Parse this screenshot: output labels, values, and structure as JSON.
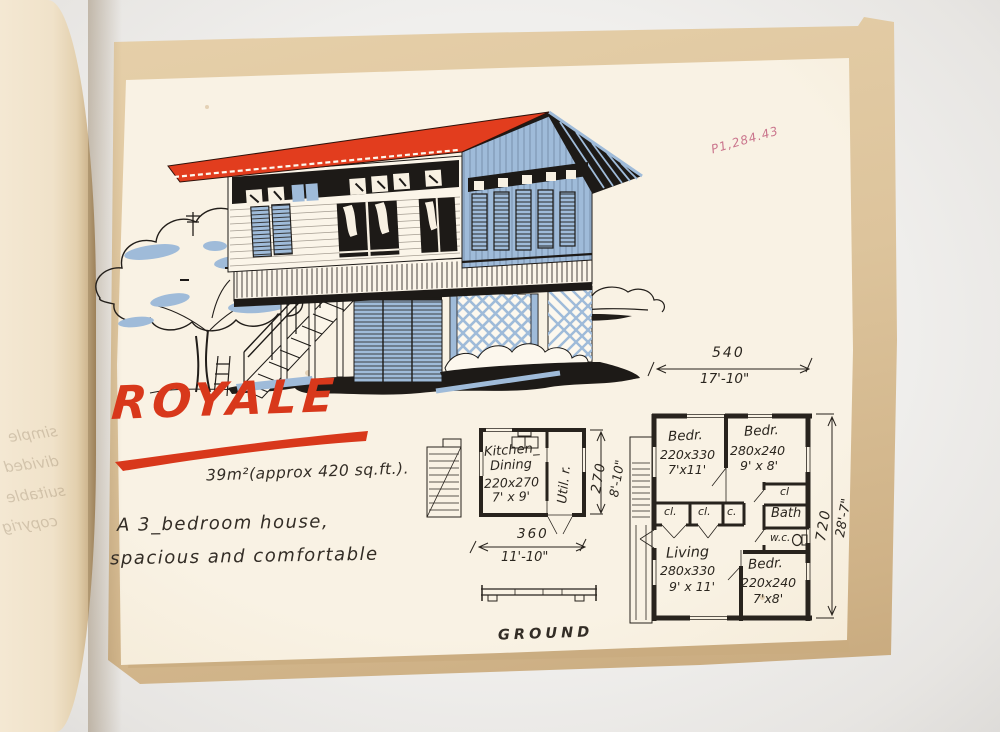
{
  "book": {
    "stamp": "P1,284.43",
    "showthrough": {
      "line1": "simple",
      "line2": "divided",
      "line3": "suitable",
      "line4": "copyrig"
    }
  },
  "page": {
    "title": "ROYALE",
    "area_note": "39m²(approx 420 sq.ft.).",
    "description": {
      "line1": "A  3_bedroom  house,",
      "line2": "spacious  and  comfortable"
    },
    "plan_label": "GROUND"
  },
  "ground_plan": {
    "kitchen": {
      "name1": "Kitchen_",
      "name2": "Dining",
      "size_cm": "220x270",
      "size_ft": "7' x 9'"
    },
    "utility": "Util. r.",
    "dim_width": {
      "cm": "360",
      "ft": "11'-10\""
    },
    "dim_depth": {
      "cm": "270",
      "ft": "8'-10\""
    }
  },
  "upper_plan": {
    "dim_width": {
      "cm": "540",
      "ft": "17'-10\""
    },
    "dim_depth": {
      "cm": "720",
      "ft": "28'-7\""
    },
    "bedroom1": {
      "name": "Bedr.",
      "size_cm": "220x330",
      "size_ft": "7'x11'"
    },
    "bedroom2": {
      "name": "Bedr.",
      "size_cm": "280x240",
      "size_ft": "9' x 8'"
    },
    "bedroom3": {
      "name": "Bedr.",
      "size_cm": "220x240",
      "size_ft": "7'x8'"
    },
    "living": {
      "name": "Living",
      "size_cm": "280x330",
      "size_ft": "9' x 11'"
    },
    "closet1": "cl.",
    "closet2": "cl.",
    "closet3": "c.",
    "closet4": "cl",
    "bath": "Bath",
    "wc": "w.c."
  },
  "colors": {
    "roof_red": "#e23d1e",
    "house_blue": "#9fbbd9",
    "ink": "#28231d",
    "stamp_pink": "#c25f7d"
  }
}
